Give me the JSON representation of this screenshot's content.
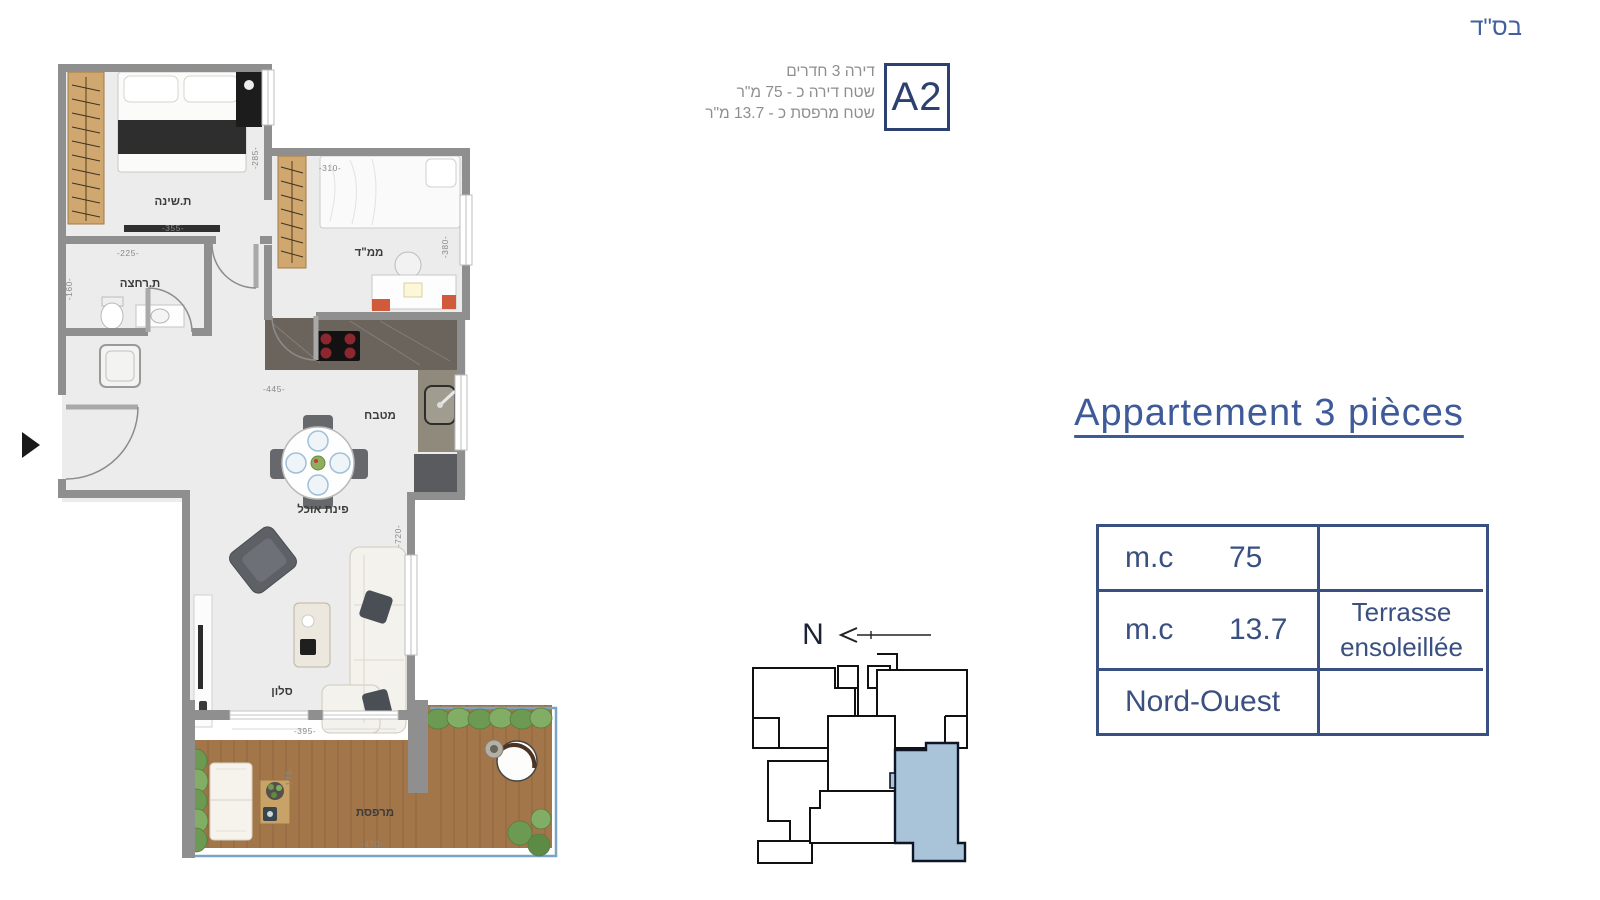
{
  "meta": {
    "bsd": "בס\"ד"
  },
  "header": {
    "unit_code": "A2",
    "info_lines": [
      "דירה 3 חדרים",
      "שטח דירה כ - 75 מ\"ר",
      "שטח מרפסת כ - 13.7 מ\"ר"
    ]
  },
  "title": "Appartement 3 pièces",
  "spec_table": {
    "rows": [
      {
        "label": "m.c",
        "value": "75",
        "note1": "",
        "note2": ""
      },
      {
        "label": "m.c",
        "value": "13.7",
        "note1": "Terrasse",
        "note2": "ensoleillée"
      },
      {
        "label": "Nord-Ouest",
        "value": "",
        "note1": "",
        "note2": ""
      }
    ]
  },
  "compass": {
    "north": "N"
  },
  "plan": {
    "rooms": {
      "bedroom": "ת.שינה",
      "safe_room": "ממ\"ד",
      "bathroom": "ת.רחצה",
      "kitchen": "מטבח",
      "dining": "פינת אוכל",
      "living": "סלון",
      "terrace": "מרפסת"
    },
    "dimensions": {
      "bedroom_w": "-355-",
      "bedroom_h": "-285-",
      "safe_room_w": "-310-",
      "safe_room_h": "-380-",
      "bathroom_w": "-225-",
      "bathroom_h": "-160-",
      "kitchen_w": "-445-",
      "living_w": "-395-",
      "living_h": "-720-",
      "terrace_w": "-470-",
      "terrace_d": "-175-"
    }
  },
  "colors": {
    "accent_navy": "#2c4170",
    "text_navy": "#3e5a99",
    "muted_gray": "#8e8e8e",
    "wall_gray": "#8f8f8f",
    "wood_deck": "#a3764a",
    "highlight_unit_blue": "#a9c3d9",
    "hedge_green": "#6d9a52"
  }
}
